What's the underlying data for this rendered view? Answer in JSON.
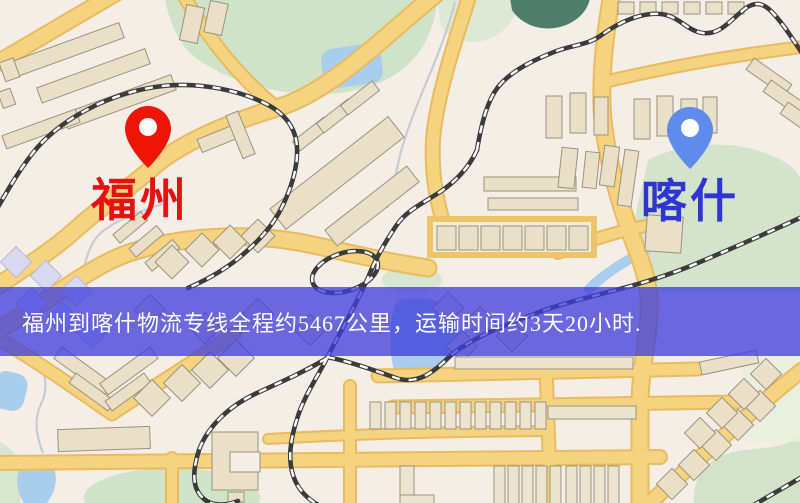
{
  "banner": {
    "text": "福州到喀什物流专线全程约5467公里，运输时间约3天20小时.",
    "distance": "5467公里",
    "duration": "3天20小时",
    "background_color": "#3e3ddd",
    "text_color": "#ffffff"
  },
  "markers": {
    "origin": {
      "label": "福州",
      "pin_color": "#ee1506",
      "label_color": "#e81010"
    },
    "destination": {
      "label": "喀什",
      "pin_color": "#5f8ceb",
      "label_color": "#2e35d1"
    }
  },
  "map_colors": {
    "base": "#f4eee7",
    "road_fill": "#f6d381",
    "road_casing": "#e8bb5f",
    "building": "#eae0c8",
    "green_area": "#cfe3c8",
    "water": "#a9cdec",
    "pond_teal": "#4f7d6c",
    "railway": "#3b3b3b"
  }
}
